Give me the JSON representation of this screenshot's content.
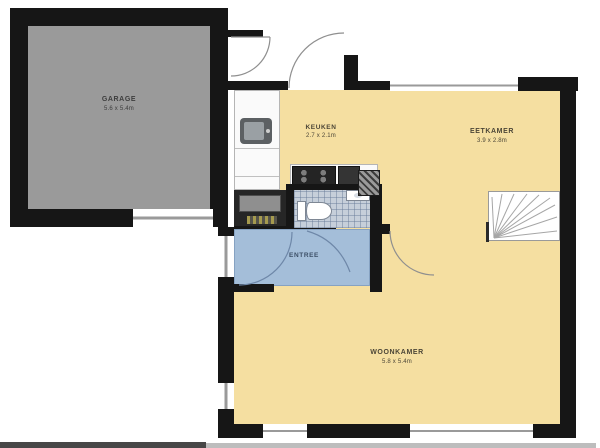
{
  "title": "Ground floor plan",
  "rooms": {
    "garage": {
      "label": "GARAGE",
      "dims": "5.6 x 5.4m"
    },
    "kitchen": {
      "label": "KEUKEN",
      "dims": "2.7 x 2.1m"
    },
    "dining": {
      "label": "EETKAMER",
      "dims": "3.9 x 2.8m"
    },
    "entree": {
      "label": "ENTREE"
    },
    "living": {
      "label": "WOONKAMER",
      "dims": "5.8 x 5.4m"
    }
  },
  "colors": {
    "wall": "#161616",
    "garage_floor": "#9a9a9a",
    "room_floor": "#f5dfa1",
    "entree_floor": "#a4bed9",
    "toilet_tile": "#c6cfda",
    "counter": "#fafafa",
    "door_arc": "#8f8f8f"
  },
  "fixtures": [
    "kitchen-counter",
    "kitchen-sink",
    "cooktop",
    "oven",
    "duct-shaft",
    "toilet",
    "hand-basin",
    "closet",
    "winder-stairs",
    "garage-door",
    "entry-doors",
    "interior-doors",
    "windows"
  ]
}
